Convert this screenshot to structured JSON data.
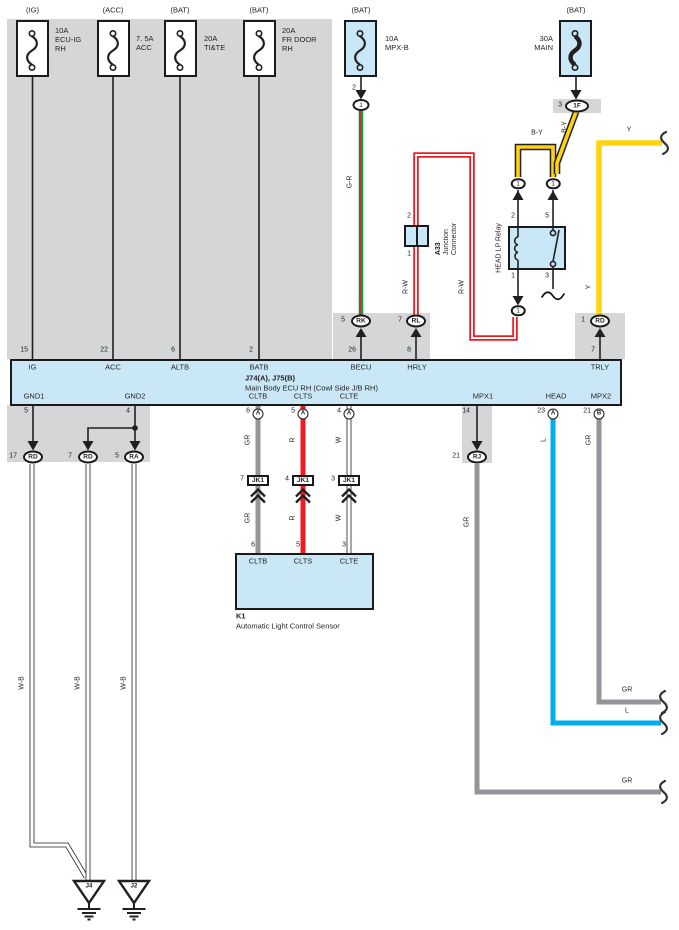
{
  "colors": {
    "component_fill": "#c9e7f7",
    "panel_gray": "#d5d6d7",
    "line_black": "#231f20",
    "wire_red": "#ec1c24",
    "wire_green": "#00a551",
    "wire_yellow": "#ffd40a",
    "wire_gray": "#939598",
    "wire_blue": "#00aeef",
    "wire_white": "#ffffff"
  },
  "fuses": [
    {
      "tag": "(IG)",
      "lines": [
        "10A",
        "ECU-IG",
        "RH"
      ]
    },
    {
      "tag": "(ACC)",
      "lines": [
        "7. 5A",
        "ACC",
        ""
      ]
    },
    {
      "tag": "(BAT)",
      "lines": [
        "20A",
        "TI&TE",
        ""
      ]
    },
    {
      "tag": "(BAT)",
      "lines": [
        "20A",
        "FR DOOR",
        "RH"
      ]
    },
    {
      "tag": "(BAT)",
      "lines": [
        "10A",
        "MPX-B",
        ""
      ]
    },
    {
      "tag": "(BAT)",
      "lines": [
        "30A",
        "MAIN",
        ""
      ]
    }
  ],
  "ecu": {
    "title": "J74(A), J75(B)",
    "subtitle": "Main Body ECU RH (Cowl Side J/B RH)",
    "top_pins": [
      {
        "num": "15",
        "label": "IG"
      },
      {
        "num": "22",
        "label": "ACC"
      },
      {
        "num": "6",
        "label": "ALTB"
      },
      {
        "num": "2",
        "label": "BATB"
      },
      {
        "num": "26",
        "label": "BECU"
      },
      {
        "num": "8",
        "label": "HRLY"
      },
      {
        "num": "7",
        "label": "TRLY"
      }
    ],
    "bottom_pins": [
      {
        "num": "5",
        "letter": "",
        "label": "GND1"
      },
      {
        "num": "4",
        "letter": "",
        "label": "GND2"
      },
      {
        "num": "6",
        "letter": "A",
        "label": "CLTB"
      },
      {
        "num": "5",
        "letter": "A",
        "label": "CLTS"
      },
      {
        "num": "4",
        "letter": "A",
        "label": "CLTE"
      },
      {
        "num": "14",
        "letter": "",
        "label": "MPX1"
      },
      {
        "num": "23",
        "letter": "A",
        "label": "HEAD"
      },
      {
        "num": "21",
        "letter": "B",
        "label": "MPX2"
      }
    ]
  },
  "relay": {
    "name": "HEAD LP Relay",
    "pin_top_left": "2",
    "pin_top_right": "5",
    "pin_bottom_left": "1",
    "pin_bottom_right": "3"
  },
  "a33": {
    "id": "A33",
    "name_line1": "Junction",
    "name_line2": "Connector",
    "pin_top": "2",
    "pin_bottom": "1"
  },
  "k1": {
    "id": "K1",
    "name": "Automatic Light Control Sensor",
    "pins": [
      {
        "num": "6",
        "label": "CLTB"
      },
      {
        "num": "5",
        "label": "CLTS"
      },
      {
        "num": "3",
        "label": "CLTE"
      }
    ]
  },
  "connectors": {
    "mpxb_out": {
      "pin": "2",
      "label": "1"
    },
    "main_out": {
      "pin": "3",
      "label": "1F"
    },
    "rk": {
      "pin": "5",
      "label": "RK"
    },
    "rl": {
      "pin": "7",
      "label": "RL"
    },
    "rd_trly": {
      "pin": "1",
      "label": "RD"
    },
    "relay_top_left": "1",
    "relay_top_right": "1",
    "relay_bottom": "1",
    "gnd_a": {
      "pin": "17",
      "label": "RD"
    },
    "gnd_b": {
      "pin": "7",
      "label": "RD"
    },
    "gnd_c": {
      "pin": "5",
      "label": "RA"
    },
    "rj": {
      "pin": "21",
      "label": "RJ"
    },
    "jk1_a": {
      "pin": "7",
      "label": "JK1"
    },
    "jk1_b": {
      "pin": "4",
      "label": "JK1"
    },
    "jk1_c": {
      "pin": "3",
      "label": "JK1"
    }
  },
  "grounds": {
    "j4": "J4",
    "j2": "J2"
  },
  "wire_labels": {
    "g_r": "G-R",
    "r_w_a": "R-W",
    "r_w_b": "R-W",
    "b_y_vert": "B-Y",
    "b_y_horiz": "B-Y",
    "y_horiz": "Y",
    "y_vert": "Y",
    "gr_cltb_top": "GR",
    "r_clts_top": "R",
    "w_clte_top": "W",
    "gr_cltb_bottom": "GR",
    "r_clts_bottom": "R",
    "w_clte_bottom": "W",
    "w_b_1": "W-B",
    "w_b_2": "W-B",
    "w_b_3": "W-B",
    "gr_rj_vert": "GR",
    "l_head_vert": "L",
    "gr_mpx2_vert": "GR",
    "gr_mpx2_horiz": "GR",
    "l_head_horiz": "L",
    "gr_rj_horiz": "GR"
  }
}
